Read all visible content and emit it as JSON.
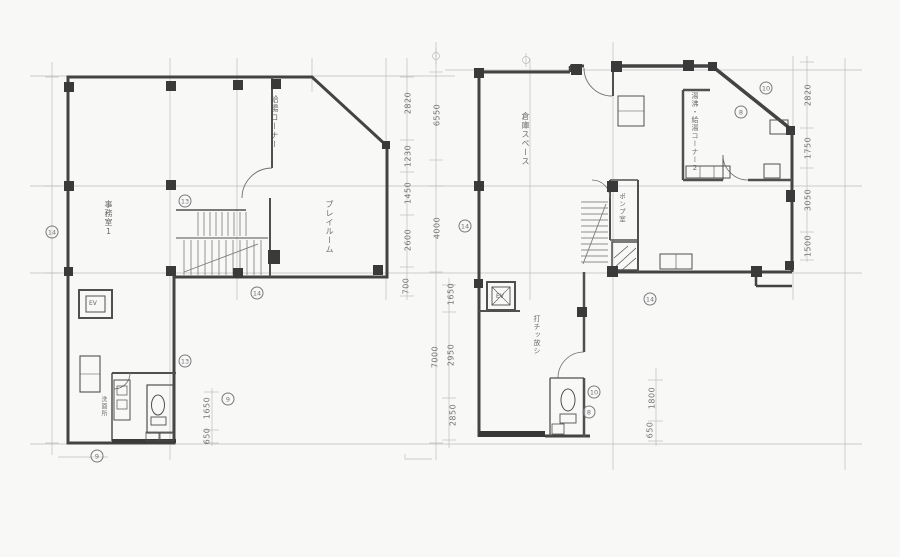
{
  "palette": {
    "paper": "#fdfdfc",
    "wall_ink": "#3c3c3c",
    "medium_ink": "#5a5a5a",
    "light_line": "#bdbdbd",
    "text_ink": "#4a4a4a"
  },
  "left_plan": {
    "room_office": "事務室1",
    "room_corner": "給湯コーナー",
    "room_play": "プレイルーム",
    "elevator": "EV",
    "washroom": "洗面所"
  },
  "right_plan": {
    "room_storage": "倉庫スペース",
    "room_hotwater": "湯沸・給湯コーナー2",
    "room_pump": "ポンプ室",
    "note_finish": "打チッ放シ",
    "elevator": "EV"
  },
  "dimensions": {
    "mid_inner": [
      "2820",
      "1230",
      "1450",
      "2600",
      "700"
    ],
    "mid_outer": [
      "6550",
      "4000",
      "7000"
    ],
    "mid_lower": [
      "1650",
      "2950",
      "2850"
    ],
    "right_edge": [
      "2820",
      "1750",
      "3050",
      "1500"
    ],
    "left_bottom": [
      "1650",
      "650"
    ],
    "right_bottom": [
      "1800",
      "650"
    ]
  },
  "markers": {
    "l1": "14",
    "l2": "13",
    "l3": "14",
    "l4": "13",
    "l5": "9",
    "l6": "9",
    "r1": "14",
    "r2": "14",
    "r3": "10",
    "r4": "8",
    "r5": "10",
    "r6": "8"
  }
}
